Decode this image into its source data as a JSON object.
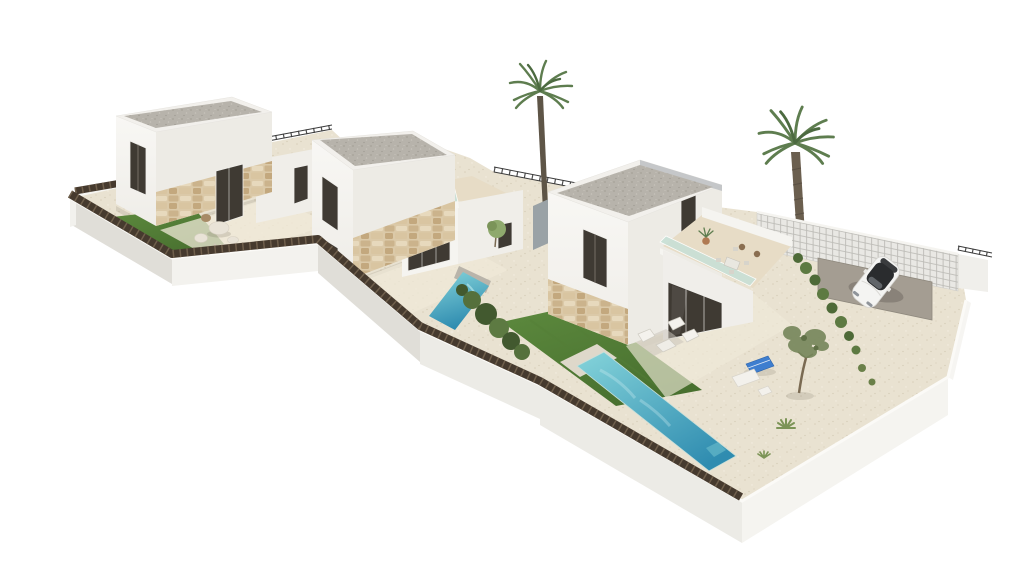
{
  "image": {
    "kind": "3d-architectural-render",
    "description": "Aerial three-quarter view of a new-build development of three modern two-storey white villas with flat gravel roofs, stone-clad bases, roof terraces with glass balustrades, private gardens with artificial lawns and turquoise pools, white boundary walls topped with dark brushwood fencing, two palm trees, an olive tree and a white sports car on a grey driveway pad, isolated on a plain white background.",
    "background": "#ffffff",
    "width": 1024,
    "height": 576
  },
  "colors": {
    "background": "#ffffff",
    "wall_white": "#f5f4f0",
    "wall_light": "#edebe5",
    "wall_shaded": "#e0ded8",
    "wall_gray_accent": "#9aa2a6",
    "roof_fascia": "#f2f0ec",
    "roof_fascia_shade": "#b9bdc0",
    "roof_gravel": "#b7b3ab",
    "stone_base": "#dbc9a8",
    "glass_dark": "#3f3a33",
    "glass_frame": "#f0efeb",
    "balustrade_glass": "#c8e0d6",
    "ground_gravel": "#e9e2d1",
    "patio_light": "#f0e9d8",
    "terrace_floor": "#e7dcc6",
    "lawn_light": "#5d8a3e",
    "lawn_dark": "#48702f",
    "pool_shallow": "#85d4da",
    "pool_deep": "#2f8cb0",
    "pool_coping": "#b9b4aa",
    "fence_dark": "#463a2e",
    "fence_post": "#6f5f4c",
    "railing": "#3b3b3b",
    "lattice_base": "#e9e8e4",
    "lattice_line": "#bdbcb7",
    "driveway": "#a49d92",
    "car_body": "#f4f4f2",
    "car_glass": "#2a2c2e",
    "palm_frond": "#5e7d4f",
    "palm_trunk": "#5e5547",
    "olive_canopy": "#75865a",
    "bush_dark": "#42592f",
    "bush_light": "#5d7a42",
    "rock_light": "#e9e3d7",
    "rock_brown": "#a78a66",
    "shadow": "rgba(90,82,68,0.14)"
  },
  "scene": {
    "villas": [
      {
        "id": "villa-1",
        "position": "rear-left",
        "storeys": 2,
        "roof": "flat gravel",
        "garden": [
          "artificial lawn",
          "gravel terrace",
          "decorative rocks"
        ],
        "features": [
          "glass balustrade roof terrace",
          "dark glazed windows",
          "natural stone cladding"
        ]
      },
      {
        "id": "villa-2",
        "position": "middle",
        "storeys": 2,
        "roof": "flat gravel",
        "garden": [
          "plunge pool",
          "shrub bed",
          "gravel patio"
        ],
        "features": [
          "glass balustrade roof terrace",
          "dark glazed sliding door",
          "natural stone cladding"
        ]
      },
      {
        "id": "villa-3",
        "position": "front-right",
        "storeys": 2,
        "roof": "flat gravel",
        "garden": [
          "large pool",
          "artificial lawn",
          "patio lounge set",
          "sun loungers",
          "olive tree",
          "driveway with parked car"
        ],
        "features": [
          "roof terrace with dining set and potted plant",
          "glass balustrade",
          "grey accent wall",
          "natural stone cladding"
        ]
      }
    ],
    "vegetation": {
      "palm_trees": 2,
      "olive_trees": 1,
      "shrub_clusters": "multiple",
      "agaves": 2
    },
    "vehicle": {
      "type": "white coupe",
      "glass": "dark",
      "location": "driveway pad, rear right"
    },
    "boundary": {
      "front": "white rendered wall topped with dark brushwood fencing",
      "rear_left": "dark brushwood hedge",
      "rear_gaps": "black metal railings",
      "rear_right": "white lattice screen wall"
    },
    "pools": 2,
    "sun_loungers": 3
  }
}
